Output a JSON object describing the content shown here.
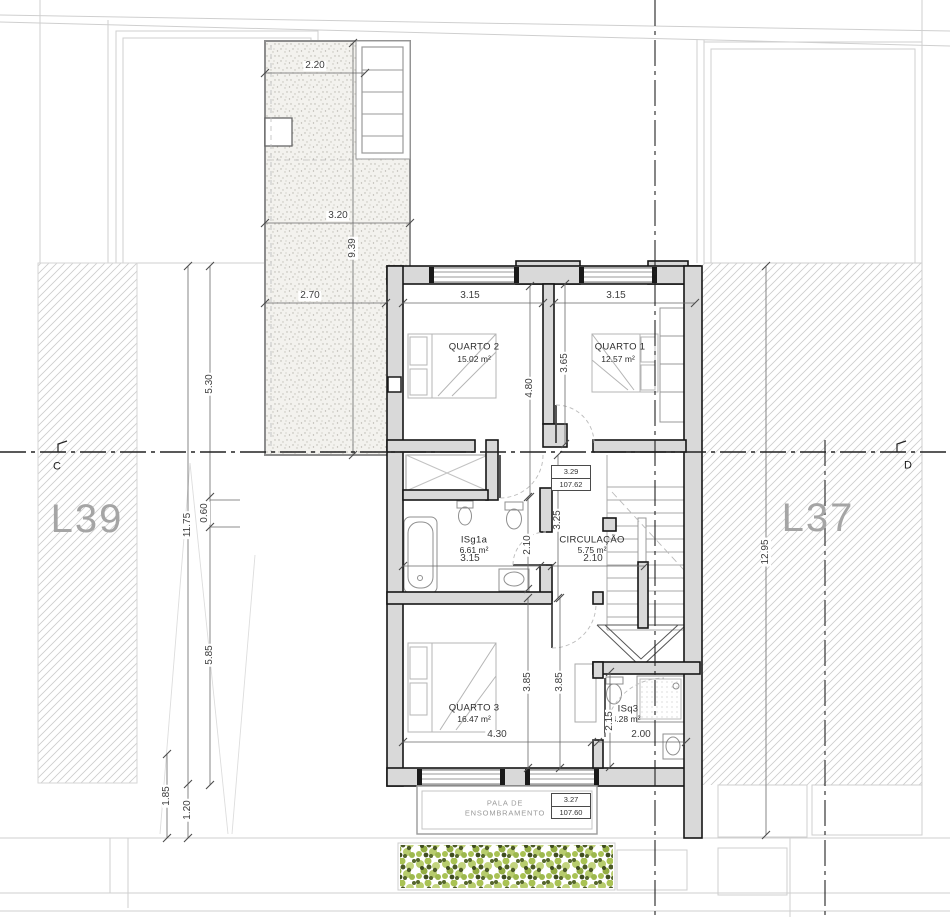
{
  "title": "Floor plan – first floor",
  "parcels": {
    "left": "L39",
    "right": "L37"
  },
  "sections": {
    "left": "C",
    "right": "D"
  },
  "rooms": {
    "quarto2": {
      "name": "QUARTO 2",
      "area": "15.02 m²"
    },
    "quarto1": {
      "name": "QUARTO 1",
      "area": "12.57 m²"
    },
    "isg1a": {
      "name": "ISg1a",
      "area": "6.61 m²"
    },
    "circulacao": {
      "name": "CIRCULAÇÃO",
      "area": "5.75 m²"
    },
    "quarto3": {
      "name": "QUARTO 3",
      "area": "16.47 m²"
    },
    "isq3": {
      "name": "ISq3",
      "area": "4.28 m²"
    }
  },
  "levels": {
    "upper": {
      "value": "3.29",
      "elevation": "107.62"
    },
    "lower": {
      "value": "3.27",
      "elevation": "107.60"
    }
  },
  "canopy": {
    "line1": "PALA DE",
    "line2": "ENSOMBRAMENTO"
  },
  "dims": {
    "terrace_width_top": "2.20",
    "terrace_width_mid": "3.20",
    "terrace_length": "9.39",
    "terrace_width_bottom": "2.70",
    "quarto2_width": "3.15",
    "quarto1_width": "3.15",
    "quarto2_depth": "4.80",
    "quarto1_depth": "3.65",
    "isg1a_width": "3.15",
    "isg1a_depth": "2.10",
    "circulacao_width": "2.10",
    "corridor_depth": "3.25",
    "quarto3_width": "4.30",
    "quarto3_depth_a": "3.85",
    "quarto3_depth_b": "3.85",
    "isq3_width": "2.00",
    "isq3_depth": "2.15",
    "left_upper": "5.30",
    "left_small": "0.60",
    "left_lower": "5.85",
    "left_total": "11.75",
    "left_bottom_a": "1.85",
    "left_bottom_b": "1.20",
    "right_total": "12.95"
  },
  "colors": {
    "wall_fill": "#d9d9d9",
    "wall_line": "#161616",
    "hatch": "#cccccc",
    "hedge_light": "#b7cc6d",
    "hedge_dark": "#46531f",
    "axis": "#222222"
  }
}
